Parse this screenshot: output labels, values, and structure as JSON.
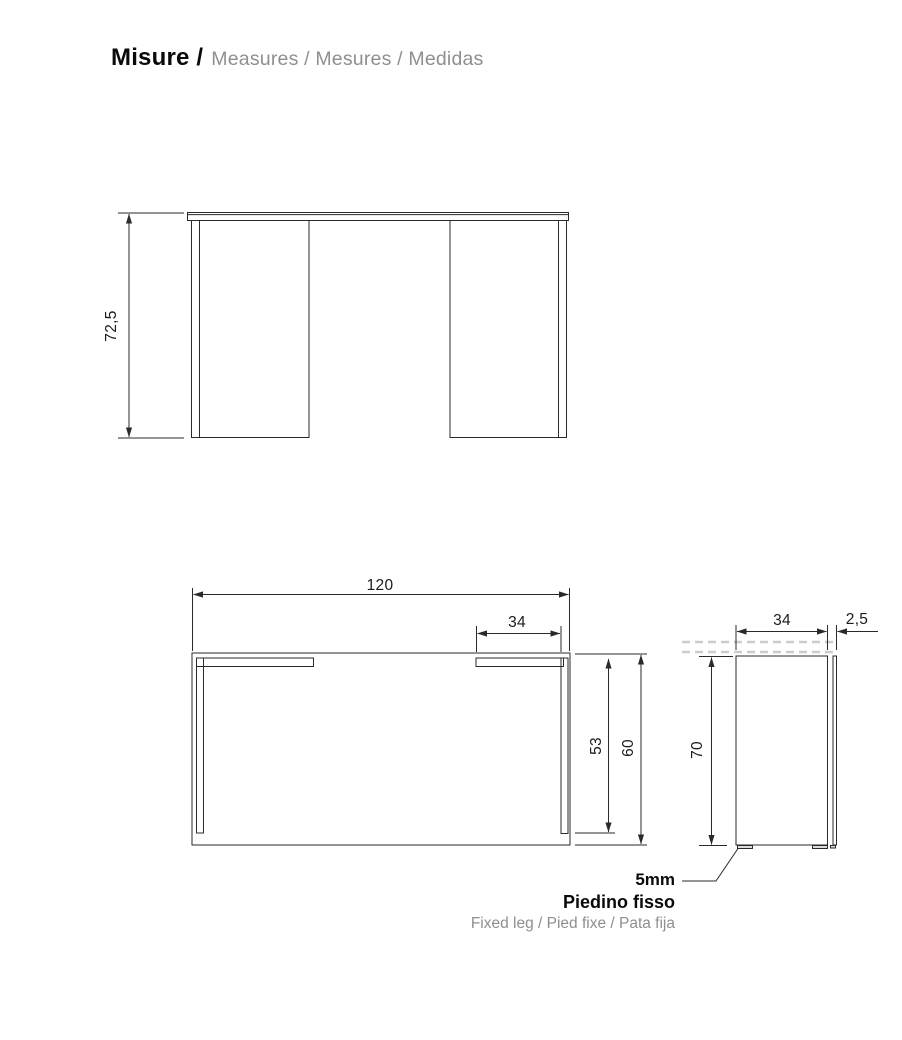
{
  "title": {
    "main": "Misure /",
    "translations": "Measures / Mesures / Medidas"
  },
  "views": {
    "front": {
      "height": "72,5"
    },
    "top": {
      "width": "120",
      "leg_top_length": "34",
      "leg_side_length": "53",
      "depth": "60"
    },
    "side": {
      "panel_depth": "34",
      "top_overhang": "2,5",
      "height": "70"
    }
  },
  "foot_note": {
    "size": "5mm",
    "name": "Piedino fisso",
    "translations": "Fixed leg / Pied fixe / Pata fija"
  },
  "colors": {
    "line": "#2a2a2a",
    "text": "#1c1c1c",
    "muted_text": "#8f8f8f",
    "dashed_line": "#cccccc",
    "background": "#ffffff"
  }
}
